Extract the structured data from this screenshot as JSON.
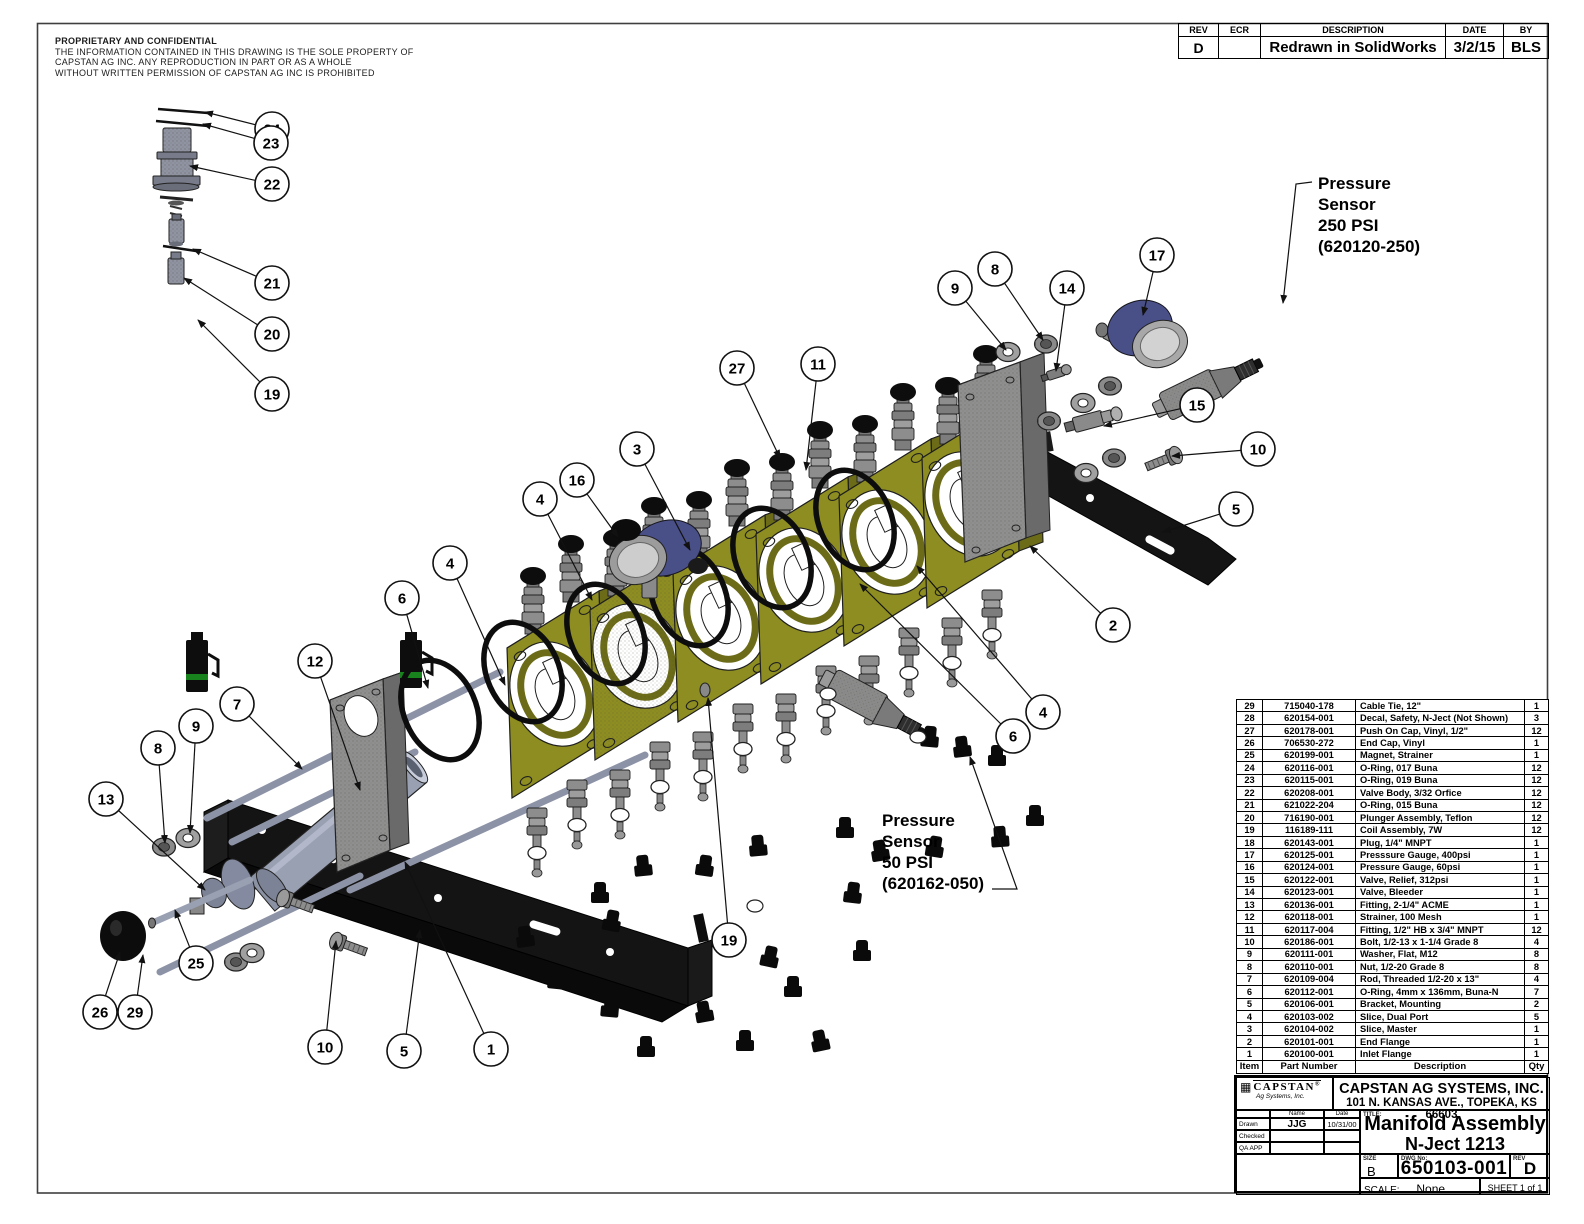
{
  "proprietary": {
    "title": "PROPRIETARY AND CONFIDENTIAL",
    "lines": [
      "THE INFORMATION CONTAINED IN THIS DRAWING IS THE SOLE PROPERTY OF",
      "CAPSTAN AG INC. ANY REPRODUCTION IN PART OR AS A WHOLE",
      "WITHOUT WRITTEN PERMISSION OF CAPSTAN AG INC IS PROHIBITED"
    ]
  },
  "revision_table": {
    "headers": [
      "REV",
      "ECR",
      "DESCRIPTION",
      "DATE",
      "BY"
    ],
    "rows": [
      {
        "rev": "D",
        "ecr": "",
        "description": "Redrawn in SolidWorks",
        "date": "3/2/15",
        "by": "BLS"
      }
    ]
  },
  "annotations": [
    {
      "lines": [
        "Pressure",
        "Sensor",
        "250 PSI",
        "(620120-250)"
      ],
      "x": 1318,
      "y": 173,
      "leader": [
        [
          1312,
          182
        ],
        [
          1296,
          184
        ],
        [
          1283,
          303
        ]
      ]
    },
    {
      "lines": [
        "Pressure",
        "Sensor",
        "50 PSI",
        "(620162-050)"
      ],
      "x": 882,
      "y": 810,
      "leader": [
        [
          992,
          889
        ],
        [
          1017,
          889
        ],
        [
          970,
          757
        ]
      ]
    }
  ],
  "balloons": [
    {
      "label": "24",
      "x": 272,
      "y": 129,
      "tx": 205,
      "ty": 112
    },
    {
      "label": "23",
      "x": 271,
      "y": 143,
      "tx": 203,
      "ty": 124
    },
    {
      "label": "22",
      "x": 272,
      "y": 184,
      "tx": 190,
      "ty": 166
    },
    {
      "label": "21",
      "x": 272,
      "y": 283,
      "tx": 193,
      "ty": 249
    },
    {
      "label": "20",
      "x": 272,
      "y": 334,
      "tx": 184,
      "ty": 278
    },
    {
      "label": "19",
      "x": 272,
      "y": 394,
      "tx": 198,
      "ty": 320
    },
    {
      "label": "12",
      "x": 315,
      "y": 661,
      "tx": 360,
      "ty": 790
    },
    {
      "label": "7",
      "x": 237,
      "y": 704,
      "tx": 302,
      "ty": 769
    },
    {
      "label": "9",
      "x": 196,
      "y": 726,
      "tx": 190,
      "ty": 833
    },
    {
      "label": "8",
      "x": 158,
      "y": 748,
      "tx": 165,
      "ty": 843
    },
    {
      "label": "13",
      "x": 106,
      "y": 799,
      "tx": 205,
      "ty": 890
    },
    {
      "label": "26",
      "x": 100,
      "y": 1012,
      "tx": 120,
      "ty": 952
    },
    {
      "label": "29",
      "x": 135,
      "y": 1012,
      "tx": 143,
      "ty": 955
    },
    {
      "label": "25",
      "x": 196,
      "y": 963,
      "tx": 175,
      "ty": 910
    },
    {
      "label": "10",
      "x": 325,
      "y": 1047,
      "tx": 336,
      "ty": 941
    },
    {
      "label": "5",
      "x": 404,
      "y": 1051,
      "tx": 420,
      "ty": 930
    },
    {
      "label": "1",
      "x": 491,
      "y": 1049,
      "tx": 405,
      "ty": 862
    },
    {
      "label": "6",
      "x": 402,
      "y": 598,
      "tx": 428,
      "ty": 688
    },
    {
      "label": "4",
      "x": 450,
      "y": 563,
      "tx": 505,
      "ty": 685
    },
    {
      "label": "4",
      "x": 540,
      "y": 499,
      "tx": 592,
      "ty": 600
    },
    {
      "label": "16",
      "x": 577,
      "y": 480,
      "tx": 618,
      "ty": 537
    },
    {
      "label": "3",
      "x": 637,
      "y": 449,
      "tx": 690,
      "ty": 550
    },
    {
      "label": "27",
      "x": 737,
      "y": 368,
      "tx": 780,
      "ty": 458
    },
    {
      "label": "11",
      "x": 818,
      "y": 364,
      "tx": 806,
      "ty": 470
    },
    {
      "label": "9",
      "x": 955,
      "y": 288,
      "tx": 1006,
      "ty": 350
    },
    {
      "label": "8",
      "x": 995,
      "y": 269,
      "tx": 1043,
      "ty": 340
    },
    {
      "label": "14",
      "x": 1067,
      "y": 288,
      "tx": 1056,
      "ty": 371
    },
    {
      "label": "17",
      "x": 1157,
      "y": 255,
      "tx": 1143,
      "ty": 315
    },
    {
      "label": "15",
      "x": 1197,
      "y": 405,
      "tx": 1104,
      "ty": 426
    },
    {
      "label": "10",
      "x": 1258,
      "y": 449,
      "tx": 1172,
      "ty": 456
    },
    {
      "label": "5",
      "x": 1236,
      "y": 509,
      "tx": 1163,
      "ty": 532
    },
    {
      "label": "2",
      "x": 1113,
      "y": 625,
      "tx": 1030,
      "ty": 546
    },
    {
      "label": "4",
      "x": 1043,
      "y": 712,
      "tx": 917,
      "ty": 566
    },
    {
      "label": "6",
      "x": 1013,
      "y": 736,
      "tx": 860,
      "ty": 584
    },
    {
      "label": "19",
      "x": 729,
      "y": 940,
      "tx": 708,
      "ty": 698
    }
  ],
  "bom": {
    "headers": [
      "Item",
      "Part Number",
      "Description",
      "Qty"
    ],
    "rows": [
      [
        "29",
        "715040-178",
        "Cable Tie, 12\"",
        "1"
      ],
      [
        "28",
        "620154-001",
        "Decal, Safety, N-Ject (Not Shown)",
        "3"
      ],
      [
        "27",
        "620178-001",
        "Push On Cap, Vinyl, 1/2\"",
        "12"
      ],
      [
        "26",
        "706530-272",
        "End Cap, Vinyl",
        "1"
      ],
      [
        "25",
        "620199-001",
        "Magnet, Strainer",
        "1"
      ],
      [
        "24",
        "620116-001",
        "O-Ring, 017 Buna",
        "12"
      ],
      [
        "23",
        "620115-001",
        "O-Ring, 019 Buna",
        "12"
      ],
      [
        "22",
        "620208-001",
        "Valve Body, 3/32 Orfice",
        "12"
      ],
      [
        "21",
        "621022-204",
        "O-Ring, 015 Buna",
        "12"
      ],
      [
        "20",
        "716190-001",
        "Plunger Assembly, Teflon",
        "12"
      ],
      [
        "19",
        "116189-111",
        "Coil Assembly, 7W",
        "12"
      ],
      [
        "18",
        "620143-001",
        "Plug, 1/4\" MNPT",
        "1"
      ],
      [
        "17",
        "620125-001",
        "Presssure Gauge, 400psi",
        "1"
      ],
      [
        "16",
        "620124-001",
        "Pressure Gauge, 60psi",
        "1"
      ],
      [
        "15",
        "620122-001",
        "Valve, Relief, 312psi",
        "1"
      ],
      [
        "14",
        "620123-001",
        "Valve, Bleeder",
        "1"
      ],
      [
        "13",
        "620136-001",
        "Fitting, 2-1/4\" ACME",
        "1"
      ],
      [
        "12",
        "620118-001",
        "Strainer, 100 Mesh",
        "1"
      ],
      [
        "11",
        "620117-004",
        "Fitting, 1/2\" HB x 3/4\" MNPT",
        "12"
      ],
      [
        "10",
        "620186-001",
        "Bolt, 1/2-13 x 1-1/4 Grade 8",
        "4"
      ],
      [
        "9",
        "620111-001",
        "Washer, Flat, M12",
        "8"
      ],
      [
        "8",
        "620110-001",
        "Nut, 1/2-20 Grade 8",
        "8"
      ],
      [
        "7",
        "620109-004",
        "Rod, Threaded 1/2-20 x 13\"",
        "4"
      ],
      [
        "6",
        "620112-001",
        "O-Ring, 4mm x 136mm, Buna-N",
        "7"
      ],
      [
        "5",
        "620106-001",
        "Bracket, Mounting",
        "2"
      ],
      [
        "4",
        "620103-002",
        "Slice, Dual Port",
        "5"
      ],
      [
        "3",
        "620104-002",
        "Slice, Master",
        "1"
      ],
      [
        "2",
        "620101-001",
        "End Flange",
        "1"
      ],
      [
        "1",
        "620100-001",
        "Inlet Flange",
        "1"
      ]
    ]
  },
  "title_block": {
    "logo_text": "CAPSTAN",
    "logo_reg": "®",
    "logo_sub": "Ag Systems, Inc.",
    "company": "CAPSTAN AG SYSTEMS, INC.",
    "address": "101 N. KANSAS AVE., TOPEKA, KS 66603",
    "name_label": "Name",
    "date_label": "Date",
    "drawn_label": "Drawn",
    "drawn_name": "JJG",
    "drawn_date": "10/31/00",
    "checked_label": "Checked",
    "qa_label": "QA APP",
    "title_label": "TITLE:",
    "title_line1": "Manifold Assembly",
    "title_line2": "N-Ject 1213",
    "size_label": "SIZE",
    "size_value": "B",
    "dwg_label": "DWG No:",
    "dwg_value": "650103-001",
    "rev_label": "REV",
    "rev_value": "D",
    "scale_label": "SCALE:",
    "scale_value": "None",
    "sheet_label": "SHEET 1 of 1"
  },
  "colors": {
    "slice_olive": "#8d8d21",
    "slice_olive_dark": "#6b6b18",
    "slice_olive_top": "#a9a938",
    "gauge_blue": "#494f87",
    "coil_green": "#18821c",
    "metal_gray": "#8a8a8a",
    "bracket_black": "#141414"
  }
}
